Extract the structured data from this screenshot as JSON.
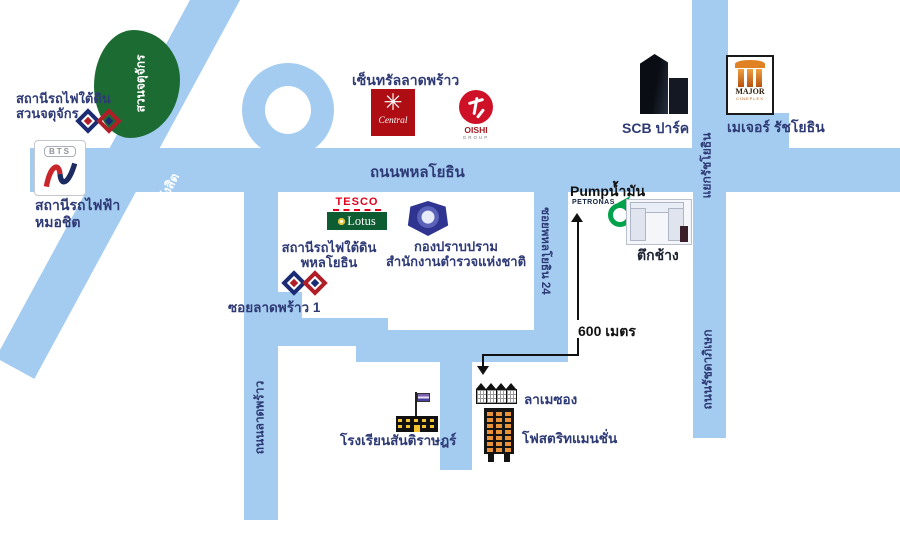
{
  "colors": {
    "road_blue": "#A4CCF1",
    "park_green": "#1C6B33",
    "label_navy": "#2E3A75",
    "central_red": "#AE0E13",
    "oishi_red": "#CE1126",
    "tesco_red": "#E2001A",
    "lotus_green": "#0E5C31",
    "major_orange": "#E08224",
    "petronas_green": "#00A24B",
    "mrt_navy": "#1C2C74",
    "mrt_red": "#B01E28",
    "mansion_orange": "#E8923A"
  },
  "park": {
    "name": "สวนจตุจักร"
  },
  "stations": {
    "mrt_chatuchak": {
      "line1": "สถานีรถไฟใต้ดิน",
      "line2": "สวนจตุจักร"
    },
    "bts_mochit": {
      "logo_text": "BTS",
      "line1": "สถานีรถไฟฟ้า",
      "line2": "หมอชิต"
    },
    "mrt_phahonyothin": {
      "line1": "สถานีรถไฟใต้ดิน",
      "line2": "พหลโยธิน"
    }
  },
  "roads": {
    "phahonyothin": "ถนนพหลโยธิน",
    "viphavadi": "ถนนวิภาวดี - รังสิต",
    "ladprao": "ถนนลาดพร้าว",
    "soi_ladprao_1": "ซอยลาดพร้าว 1",
    "soi_phahonyothin_24": "ซอยพหลโยธิน 24",
    "ratchayothin_intersection": "แยกรัชโยธิน",
    "ratchadaphisek": "ถนนรัชดาภิเษก"
  },
  "landmarks": {
    "central": {
      "label": "เซ็นทรัลลาดพร้าว",
      "logo_text": "Central",
      "logo_star": "✳"
    },
    "oishi": {
      "logo_text": "OISHI",
      "logo_sub": "GROUP"
    },
    "scb_park": {
      "label": "SCB ปาร์ค"
    },
    "major": {
      "label": "เมเจอร์ รัชโยธิน",
      "logo_text": "MAJOR",
      "logo_sub": "CINEPLEX"
    },
    "tesco_lotus": {
      "line1": "TESCO",
      "line2": "Lotus"
    },
    "police": {
      "line1": "กองปราบปราม",
      "line2": "สำนักงานตำรวจแห่งชาติ"
    },
    "petronas": {
      "label": "Pumpน้ำมัน",
      "brand": "PETRONAS"
    },
    "elephant_tower": {
      "label": "ตึกช้าง"
    },
    "school": {
      "label": "โรงเรียนสันติราษฎร์"
    },
    "la_maison": {
      "label": "ลาเมซอง"
    },
    "mansion": {
      "label": "โฟสตริทแมนชั่น"
    }
  },
  "annotations": {
    "distance": "600 เมตร"
  }
}
